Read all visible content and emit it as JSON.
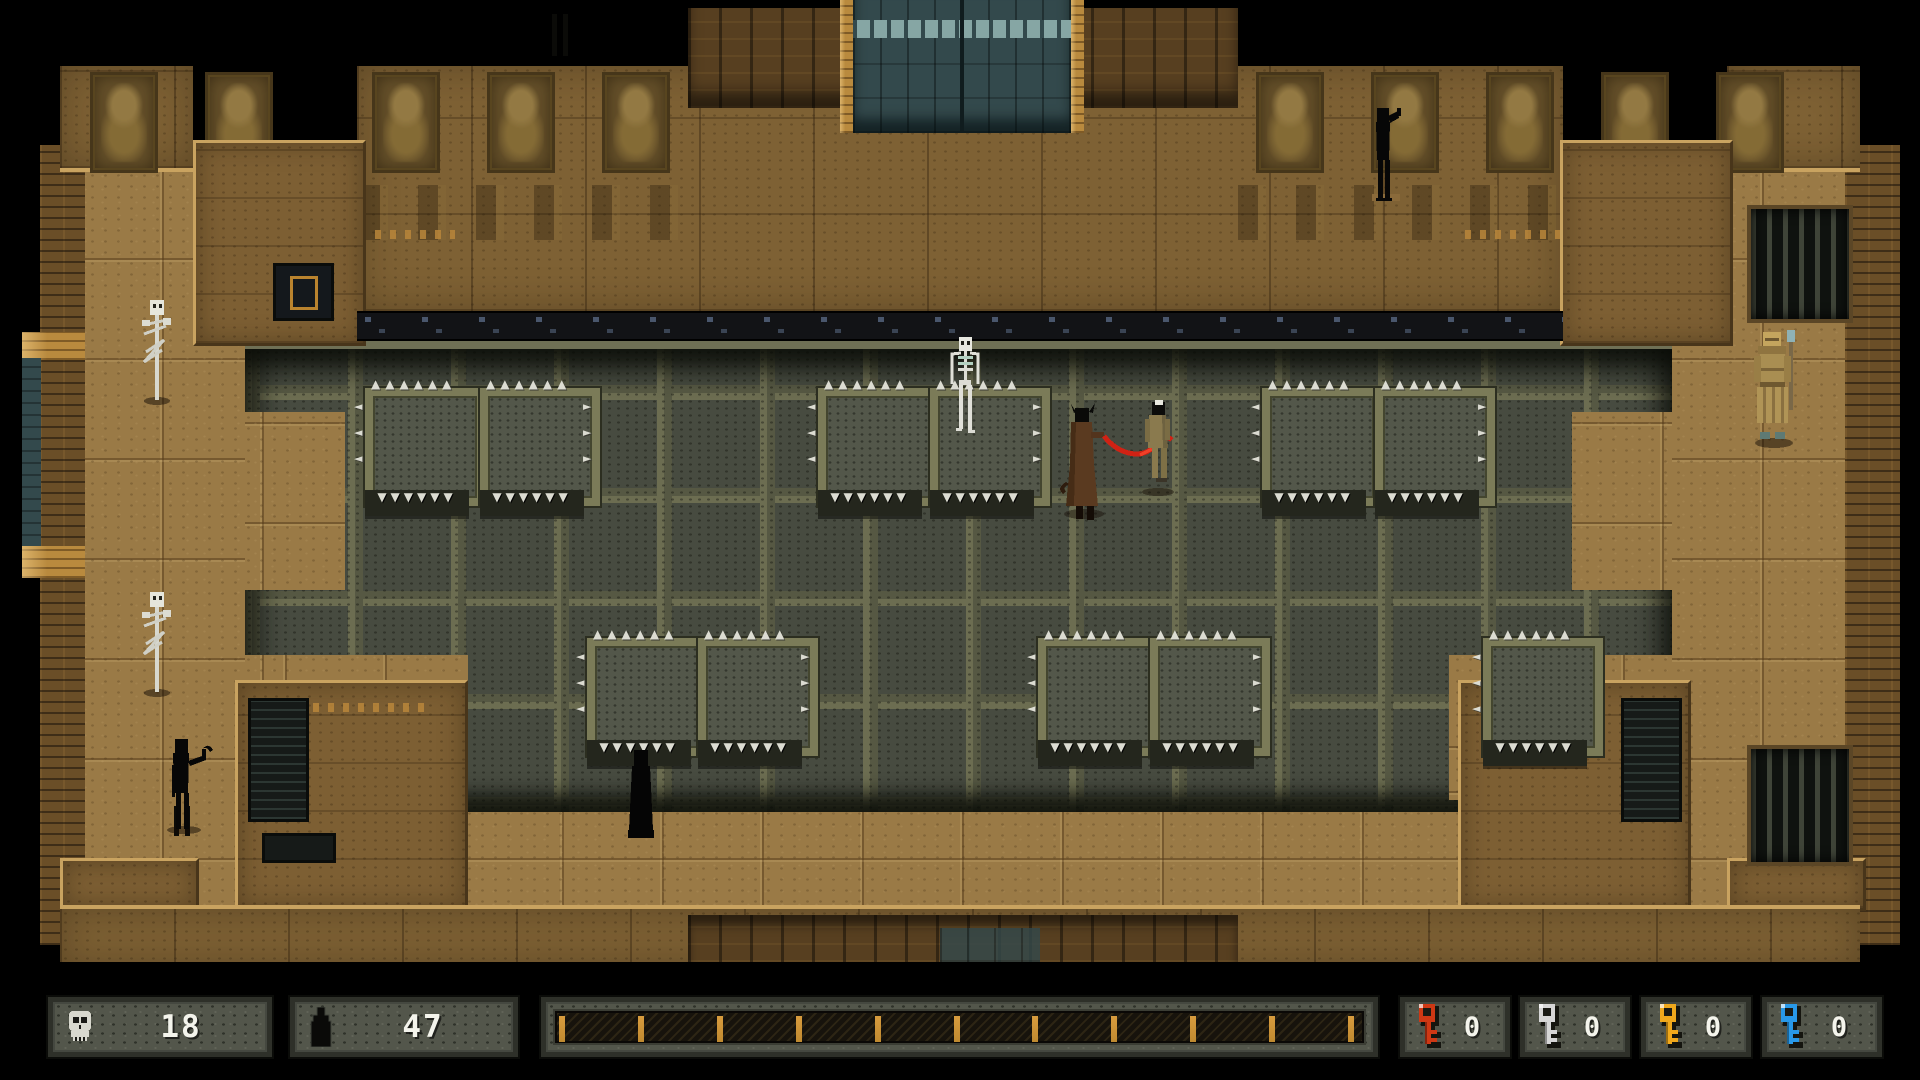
{
  "hud": {
    "skull_counter": {
      "icon": "skull-icon",
      "value": "18"
    },
    "spirit_counter": {
      "icon": "dark-figure-icon",
      "value": "47"
    },
    "progress": {
      "ticks": 11,
      "tick_color": "#c08a30",
      "label": "level-progress"
    },
    "keys": [
      {
        "name": "red-key",
        "color": "#cf3814",
        "count": "0"
      },
      {
        "name": "silver-key",
        "color": "#d6d6d6",
        "count": "0"
      },
      {
        "name": "gold-key",
        "color": "#f0a81c",
        "count": "0"
      },
      {
        "name": "blue-key",
        "color": "#2898e8",
        "count": "0"
      }
    ]
  },
  "palette": {
    "floor": "#9a7a46",
    "wall": "#7e6134",
    "pit": "#474b40",
    "platform_brick": "#7b7b58",
    "door_teal": "#33494c",
    "wood": "#b98a3e",
    "whip_red": "#d02214",
    "bone": "#e0e0d6"
  },
  "scene": {
    "frieze_panels_x": [
      90,
      205,
      372,
      487,
      602,
      1256,
      1371,
      1486,
      1601,
      1716
    ],
    "platforms": [
      {
        "x": 365,
        "y": 388,
        "side": "L"
      },
      {
        "x": 480,
        "y": 388,
        "side": "R"
      },
      {
        "x": 818,
        "y": 388,
        "side": "L"
      },
      {
        "x": 930,
        "y": 388,
        "side": "R"
      },
      {
        "x": 1262,
        "y": 388,
        "side": "L"
      },
      {
        "x": 1375,
        "y": 388,
        "side": "R"
      },
      {
        "x": 587,
        "y": 638,
        "side": "L"
      },
      {
        "x": 698,
        "y": 638,
        "side": "R"
      },
      {
        "x": 1038,
        "y": 638,
        "side": "L"
      },
      {
        "x": 1150,
        "y": 638,
        "side": "R"
      },
      {
        "x": 1483,
        "y": 638,
        "side": "L"
      }
    ],
    "sprites": [
      {
        "type": "skeleton_pole",
        "name": "impaled-skeleton-totem",
        "x": 136,
        "y": 300
      },
      {
        "type": "skeleton_pole",
        "name": "impaled-skeleton-totem",
        "x": 136,
        "y": 592
      },
      {
        "type": "skeleton",
        "name": "skeleton-enemy",
        "x": 944,
        "y": 336
      },
      {
        "type": "silhouette_drink",
        "name": "dark-figure-drinking",
        "x": 1368,
        "y": 106
      },
      {
        "type": "silhouette_pipe",
        "name": "dark-figure-with-hook",
        "x": 160,
        "y": 735
      },
      {
        "type": "hooded",
        "name": "hooded-figure",
        "x": 622,
        "y": 750
      },
      {
        "type": "guard",
        "name": "guard-statue",
        "x": 1748,
        "y": 330
      },
      {
        "type": "fight_group",
        "name": "player-whip-attack",
        "x": 1052,
        "y": 400
      }
    ]
  }
}
